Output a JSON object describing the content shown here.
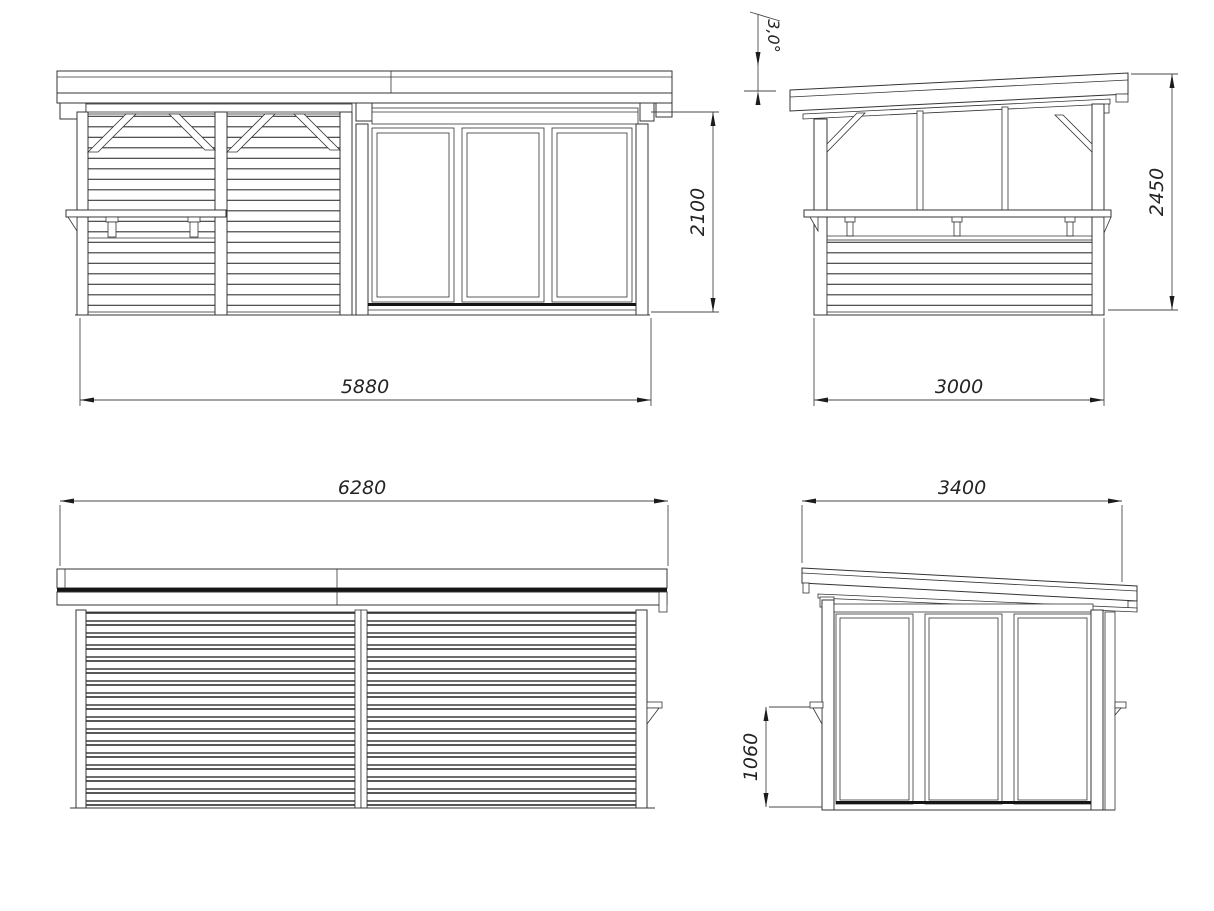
{
  "drawing": {
    "background": "#ffffff",
    "line_color": "#343434",
    "views": {
      "front": {
        "width_mm": "5880",
        "height_mm": "2100"
      },
      "side_a": {
        "roof_angle_deg": "3,0°",
        "height_mm": "2450",
        "depth_mm": "3000"
      },
      "rear": {
        "width_mm": "6280"
      },
      "side_b": {
        "depth_mm": "3400",
        "counter_height_mm": "1060"
      }
    }
  }
}
